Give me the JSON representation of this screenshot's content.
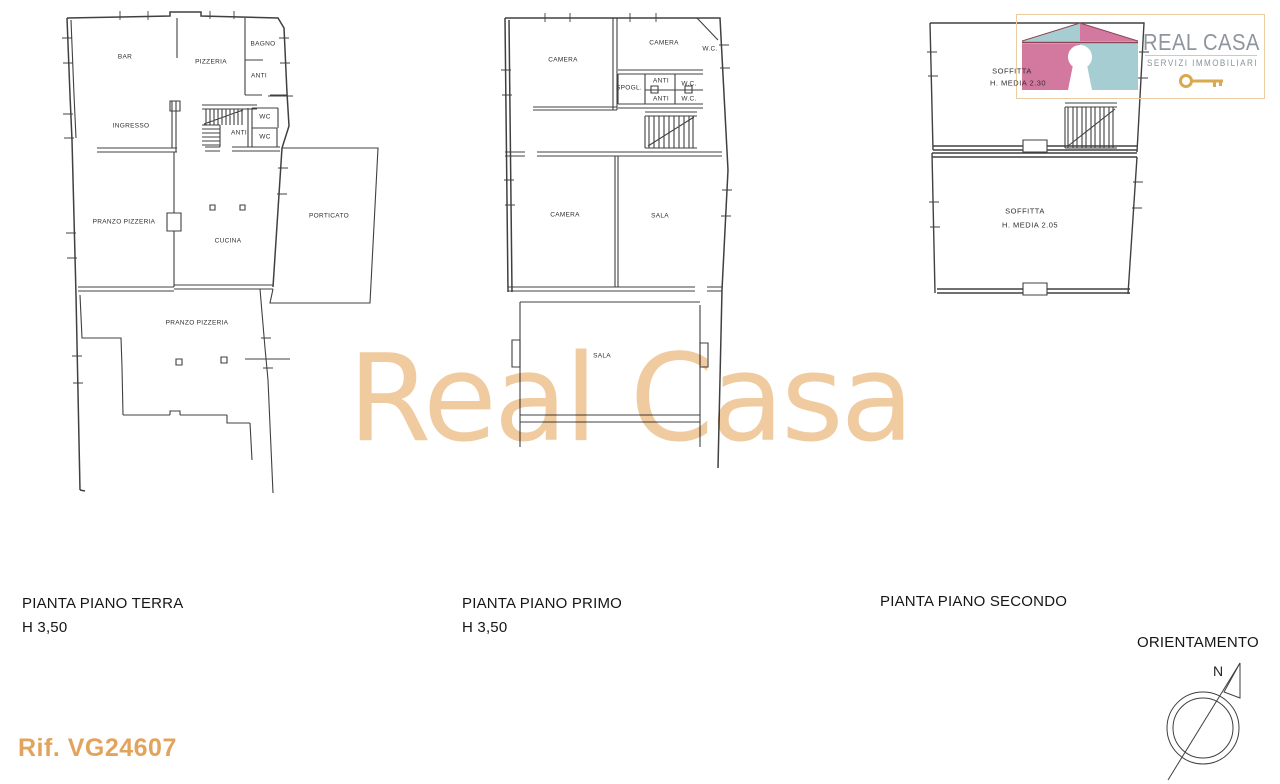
{
  "sheet": {
    "watermark": "Real Casa",
    "reference": "Rif. VG24607"
  },
  "logo": {
    "brand": "REAL CASA",
    "tagline": "SERVIZI IMMOBILIARI",
    "colors": {
      "pink": "#d3799f",
      "teal": "#a6ced2",
      "roof_line": "#8c4352",
      "key_gold": "#d8a94f",
      "brand_text": "#8f959d",
      "border": "#eccaa2",
      "watermark": "#eec28e",
      "reference_text": "#e2a45c"
    }
  },
  "floors": [
    {
      "id": "terra",
      "caption": "PIANTA PIANO TERRA",
      "height_note": "H 3,50",
      "rooms": [
        {
          "label": "BAR"
        },
        {
          "label": "PIZZERIA"
        },
        {
          "label": "BAGNO"
        },
        {
          "label": "ANTI"
        },
        {
          "label": "INGRESSO"
        },
        {
          "label": "ANTI"
        },
        {
          "label": "WC"
        },
        {
          "label": "WC"
        },
        {
          "label": "PRANZO PIZZERIA"
        },
        {
          "label": "CUCINA"
        },
        {
          "label": "PORTICATO"
        },
        {
          "label": "PRANZO PIZZERIA"
        }
      ]
    },
    {
      "id": "primo",
      "caption": "PIANTA PIANO PRIMO",
      "height_note": "H 3,50",
      "rooms": [
        {
          "label": "CAMERA"
        },
        {
          "label": "CAMERA"
        },
        {
          "label": "W.C."
        },
        {
          "label": "SPOGL."
        },
        {
          "label": "ANTI"
        },
        {
          "label": "W.C."
        },
        {
          "label": "ANTI"
        },
        {
          "label": "W.C."
        },
        {
          "label": "CAMERA"
        },
        {
          "label": "SALA"
        },
        {
          "label": "SALA"
        }
      ]
    },
    {
      "id": "secondo",
      "caption": "PIANTA PIANO SECONDO",
      "height_note": "",
      "rooms": [
        {
          "label": "SOFFITTA"
        },
        {
          "label": "H. MEDIA 2.30"
        },
        {
          "label": "SOFFITTA"
        },
        {
          "label": "H. MEDIA 2.05"
        }
      ]
    }
  ],
  "orientation": {
    "title": "ORIENTAMENTO",
    "north_label": "N"
  }
}
